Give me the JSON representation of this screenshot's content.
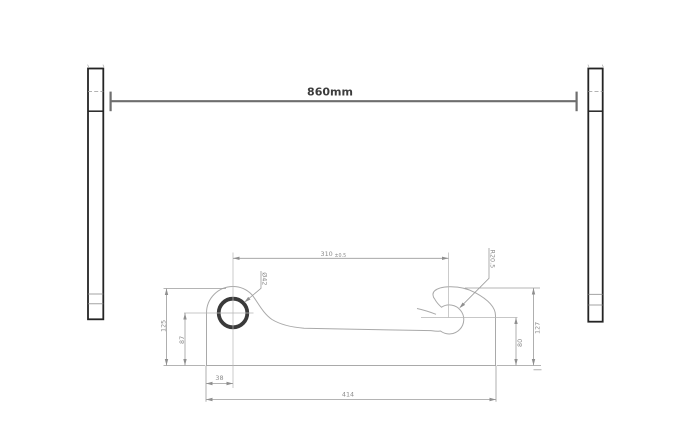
{
  "dimensions": {
    "overall_width": "860mm",
    "pin_center_distance": "310",
    "pin_center_tolerance": "±0.5",
    "hook_radius": "R20.5",
    "hole_diameter": "Ø42",
    "left_height_outer": "125",
    "left_height_inner": "87",
    "hole_offset_x": "38",
    "base_length": "414",
    "right_height_inner": "80",
    "right_height_outer": "127"
  },
  "colors": {
    "background": "#ffffff",
    "plate_outline": "#242424",
    "part_outline": "#a9a9a9",
    "dimension_lines": "#9b9b9b",
    "dimension_text": "#8a8a8a",
    "main_dimension_line": "#6e6e6e",
    "main_dimension_text": "#3c3c3c"
  }
}
